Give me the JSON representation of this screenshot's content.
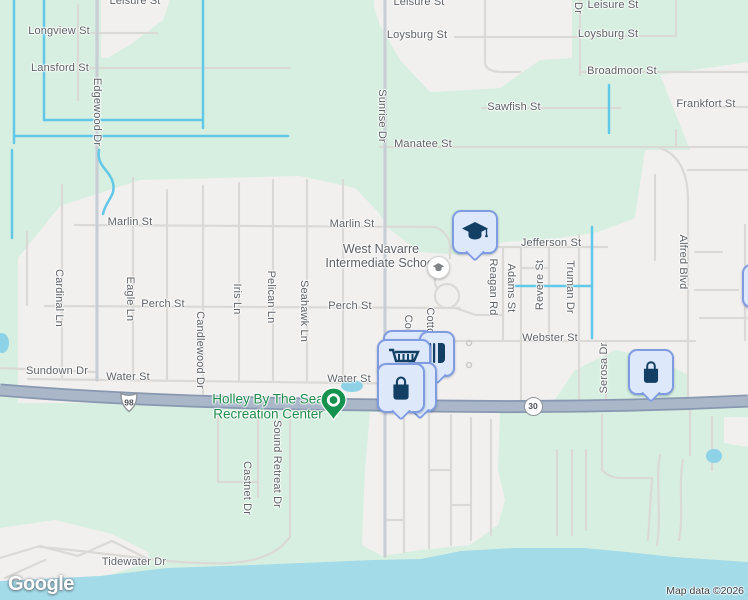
{
  "map": {
    "provider_logo": "Google",
    "attribution": "Map data ©2026",
    "colors": {
      "land_green": "#d7efe0",
      "residential": "#f2f0ef",
      "water": "#a3dbe9",
      "canal": "#62c8e8",
      "road_minor": "#dbd9d6",
      "road_arterial": "#c9ced5",
      "highway_fill": "#a9b7c9",
      "highway_casing": "#8898b0",
      "pin_bg": "#dde8fa",
      "pin_border": "#7f9ce2",
      "pin_glyph": "#123f63",
      "park_pin_green": "#15924e",
      "park_label_green": "#1f8c4c",
      "street_label": "#5d6166"
    },
    "shields": [
      {
        "type": "us-route",
        "number": "98"
      },
      {
        "type": "state-route",
        "number": "30"
      }
    ],
    "places": [
      {
        "name": "West Navarre Intermediate School",
        "line1": "West Navarre",
        "line2": "Intermediate School",
        "icon": "school"
      },
      {
        "name": "Holley By The Sea Recreation Center",
        "line1": "Holley By The Sea",
        "line2": "Recreation Center",
        "icon": "park-pin"
      }
    ],
    "poi_pins": [
      {
        "icon": "school-pin",
        "kind": "school"
      },
      {
        "icon": "store",
        "kind": "shopping"
      },
      {
        "icon": "restaurant",
        "kind": "food"
      },
      {
        "icon": "grocery-cart",
        "kind": "grocery"
      },
      {
        "icon": "shopping-bag",
        "kind": "shopping"
      },
      {
        "icon": "shopping-bag",
        "kind": "shopping"
      },
      {
        "icon": "shopping-bag",
        "kind": "shopping"
      }
    ],
    "street_labels": [
      {
        "text": "Leisure St",
        "x": 135,
        "y": 1,
        "o": "h"
      },
      {
        "text": "Leisure St",
        "x": 419,
        "y": 2,
        "o": "h"
      },
      {
        "text": "Leisure St",
        "x": 613,
        "y": 5,
        "o": "h"
      },
      {
        "text": "Dr",
        "x": 578,
        "y": 8,
        "o": "v"
      },
      {
        "text": "Longview St",
        "x": 59,
        "y": 31,
        "o": "h"
      },
      {
        "text": "Loysburg St",
        "x": 417,
        "y": 35,
        "o": "h"
      },
      {
        "text": "Loysburg St",
        "x": 608,
        "y": 34,
        "o": "h"
      },
      {
        "text": "Lansford St",
        "x": 60,
        "y": 68,
        "o": "h"
      },
      {
        "text": "Broadmoor St",
        "x": 622,
        "y": 71,
        "o": "h"
      },
      {
        "text": "Sawfish St",
        "x": 514,
        "y": 107,
        "o": "h"
      },
      {
        "text": "Frankfort St",
        "x": 706,
        "y": 104,
        "o": "h"
      },
      {
        "text": "Manatee St",
        "x": 423,
        "y": 144,
        "o": "h"
      },
      {
        "text": "Edgewood Dr",
        "x": 97,
        "y": 112,
        "o": "v"
      },
      {
        "text": "Sunrise Dr",
        "x": 382,
        "y": 116,
        "o": "v"
      },
      {
        "text": "Marlin St",
        "x": 130,
        "y": 222,
        "o": "h"
      },
      {
        "text": "Marlin St",
        "x": 352,
        "y": 224,
        "o": "h"
      },
      {
        "text": "Jefferson St",
        "x": 551,
        "y": 243,
        "o": "h"
      },
      {
        "text": "Cardinal Ln",
        "x": 59,
        "y": 298,
        "o": "v"
      },
      {
        "text": "Eagle Ln",
        "x": 130,
        "y": 299,
        "o": "v"
      },
      {
        "text": "Iris Ln",
        "x": 237,
        "y": 299,
        "o": "v"
      },
      {
        "text": "Pelican Ln",
        "x": 271,
        "y": 297,
        "o": "v"
      },
      {
        "text": "Seahawk Ln",
        "x": 304,
        "y": 311,
        "o": "v"
      },
      {
        "text": "Candlewood Dr",
        "x": 200,
        "y": 350,
        "o": "v"
      },
      {
        "text": "Perch St",
        "x": 163,
        "y": 304,
        "o": "h"
      },
      {
        "text": "Perch St",
        "x": 350,
        "y": 306,
        "o": "h"
      },
      {
        "text": "Sundown Dr",
        "x": 57,
        "y": 371,
        "o": "h"
      },
      {
        "text": "Water St",
        "x": 128,
        "y": 377,
        "o": "h"
      },
      {
        "text": "Water St",
        "x": 349,
        "y": 379,
        "o": "h"
      },
      {
        "text": "Con",
        "x": 408,
        "y": 325,
        "o": "v"
      },
      {
        "text": "Cotton",
        "x": 430,
        "y": 324,
        "o": "v"
      },
      {
        "text": "Reagan Rd",
        "x": 493,
        "y": 287,
        "o": "v"
      },
      {
        "text": "Adams St",
        "x": 511,
        "y": 288,
        "o": "v"
      },
      {
        "text": "Revere St",
        "x": 540,
        "y": 285,
        "o": "vu"
      },
      {
        "text": "Truman Dr",
        "x": 570,
        "y": 287,
        "o": "v"
      },
      {
        "text": "Alfred Blvd",
        "x": 683,
        "y": 262,
        "o": "v"
      },
      {
        "text": "Webster St",
        "x": 550,
        "y": 338,
        "o": "h"
      },
      {
        "text": "Serosa Dr",
        "x": 604,
        "y": 368,
        "o": "vu"
      },
      {
        "text": "Tidewater Dr",
        "x": 134,
        "y": 562,
        "o": "h"
      },
      {
        "text": "Castnet Dr",
        "x": 247,
        "y": 488,
        "o": "v"
      },
      {
        "text": "Sound Retreat Dr",
        "x": 277,
        "y": 464,
        "o": "v"
      }
    ]
  }
}
